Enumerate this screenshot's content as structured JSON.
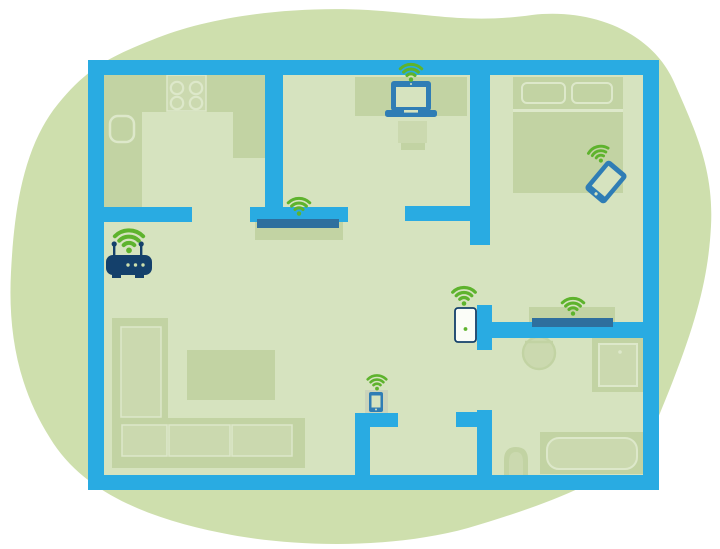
{
  "title": "Wi-Fi coverage home floor plan illustration",
  "diagram": {
    "type": "home-floorplan-wifi-coverage",
    "text": [],
    "colors": {
      "background": "#ffffff",
      "blob": "#cedfad",
      "floor": "#d6e3bf",
      "wall": "#29abe2",
      "furniture": "#c2d3a3",
      "furniture_light": "#cbd9af",
      "outline_light": "#dde8ca",
      "device_blue": "#2f7db5",
      "device_navy": "#14406b",
      "device_steel": "#2e6f9e",
      "wifi_green": "#5eb32d",
      "repeater_white": "#fbfdf8",
      "stand_grey": "#cbd4bb"
    },
    "rooms": [
      {
        "name": "kitchen",
        "position": "top-left",
        "furniture": [
          "u-shaped-counter",
          "stove-4-burners",
          "sink"
        ]
      },
      {
        "name": "office",
        "position": "top-center",
        "furniture": [
          "desk",
          "chair",
          "wall-shelf"
        ]
      },
      {
        "name": "bedroom",
        "position": "top-right",
        "furniture": [
          "double-bed",
          "pillow",
          "pillow"
        ]
      },
      {
        "name": "living-room",
        "position": "center-left",
        "furniture": [
          "l-shaped-sofa",
          "coffee-table"
        ]
      },
      {
        "name": "hallway",
        "position": "bottom-center",
        "furniture": [
          "phone-stand"
        ]
      },
      {
        "name": "bathroom",
        "position": "right",
        "furniture": [
          "round-sink",
          "shower",
          "toilet",
          "bathtub"
        ]
      }
    ],
    "devices": [
      {
        "name": "wifi-router",
        "room": "living-room",
        "color": "navy",
        "has_wifi_signal": true
      },
      {
        "name": "laptop",
        "room": "office",
        "color": "blue",
        "has_wifi_signal": true
      },
      {
        "name": "powerline-extender-bar",
        "room": "office-wall-shelf",
        "color": "steel-blue",
        "has_wifi_signal": true
      },
      {
        "name": "tablet",
        "room": "bedroom",
        "color": "blue",
        "has_wifi_signal": true
      },
      {
        "name": "plug-in-wifi-repeater",
        "room": "hallway-wall",
        "color": "white",
        "has_wifi_signal": true
      },
      {
        "name": "powerline-extender-bar",
        "room": "bathroom-wall-shelf",
        "color": "steel-blue",
        "has_wifi_signal": true
      },
      {
        "name": "smartphone",
        "room": "hallway",
        "color": "blue",
        "has_wifi_signal": true
      }
    ],
    "wifi_icon_count": 7
  }
}
